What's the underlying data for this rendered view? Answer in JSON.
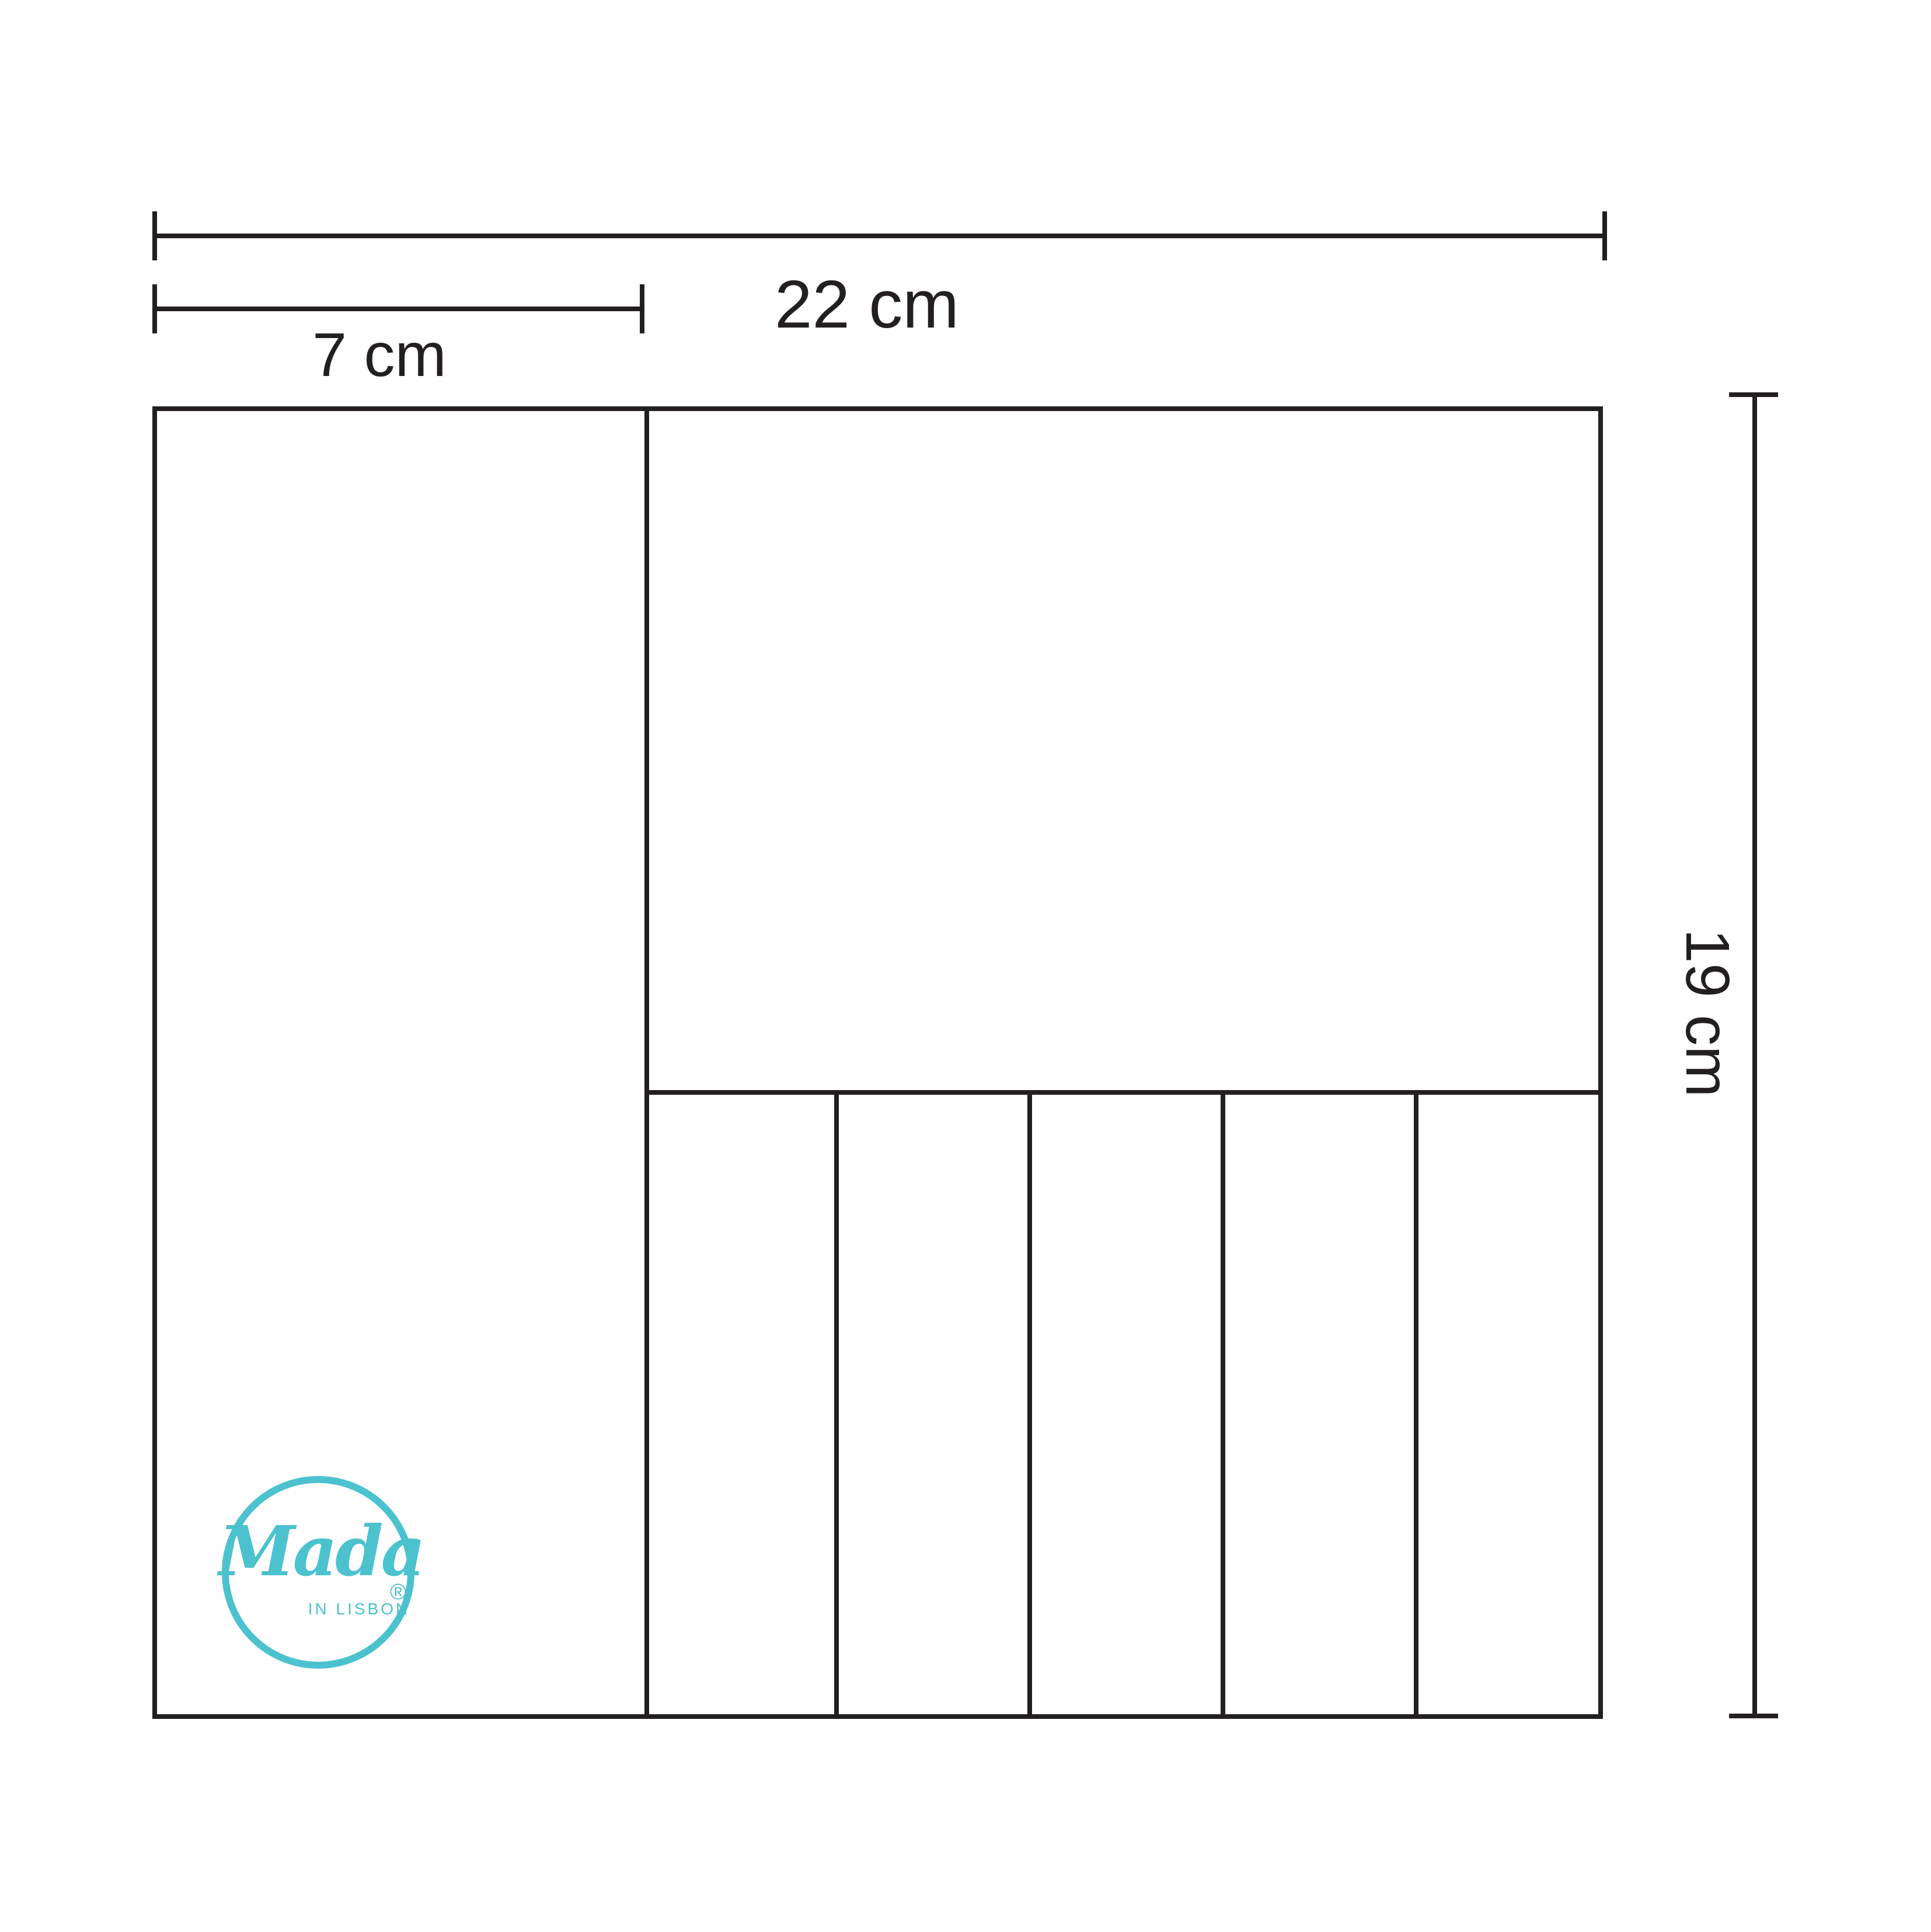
{
  "diagram": {
    "dimensions": {
      "total_width": {
        "label": "22 cm"
      },
      "left_column_width": {
        "label": "7 cm"
      },
      "total_height": {
        "label": "19 cm"
      }
    },
    "structure": {
      "left_column_compartments": 1,
      "top_compartments": 1,
      "bottom_slot_compartments": 5
    }
  },
  "logo": {
    "brand": "Mada",
    "registered_mark": "®",
    "tagline": "IN LISBON"
  },
  "colors": {
    "line": "#231f20",
    "accent": "#4cc2cf"
  }
}
